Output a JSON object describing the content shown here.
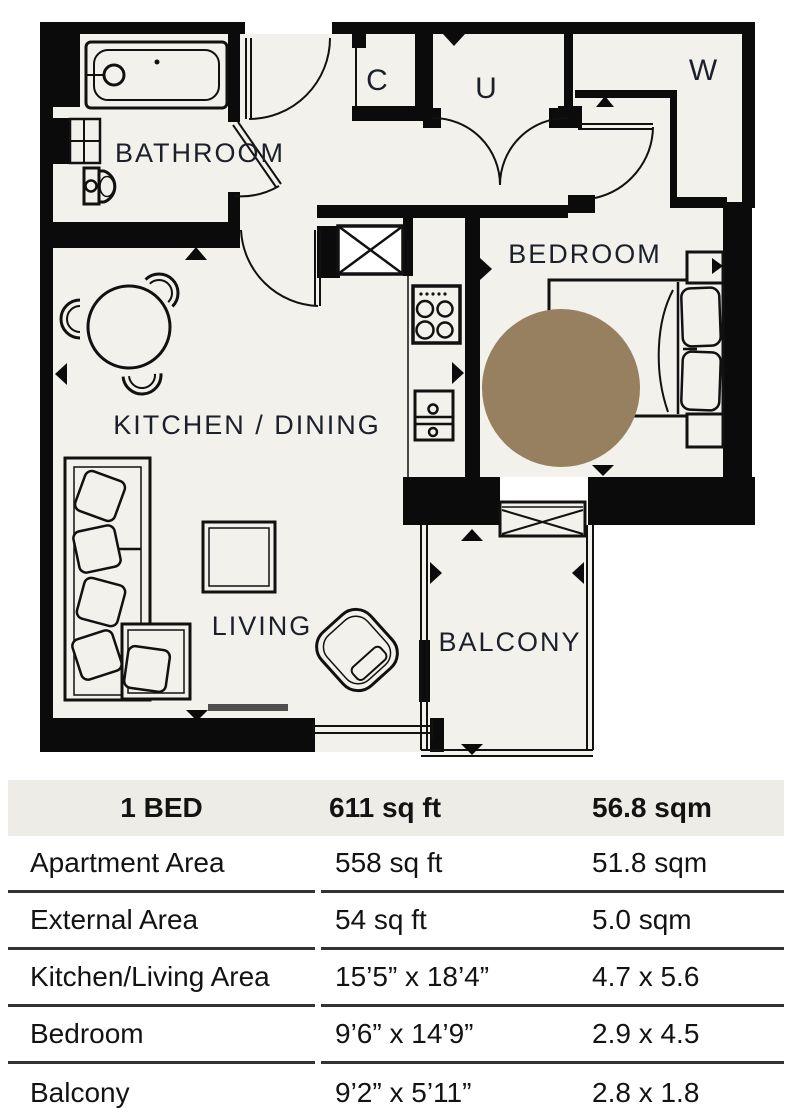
{
  "plan": {
    "labels": {
      "bathroom": "BATHROOM",
      "closet_c": "C",
      "utility_u": "U",
      "wardrobe_w": "W",
      "bedroom": "BEDROOM",
      "kitchen_dining": "KITCHEN / DINING",
      "living": "LIVING",
      "balcony": "BALCONY"
    },
    "marker_color": "#97805f",
    "floor_color": "#f3f1ec",
    "wall_color": "#0b0b0b"
  },
  "table": {
    "header": {
      "col1": "1 BED",
      "col2": "611 sq ft",
      "col3": "56.8 sqm"
    },
    "rows": [
      {
        "label": "Apartment Area",
        "imperial": "558 sq ft",
        "metric": "51.8 sqm"
      },
      {
        "label": "External Area",
        "imperial": "54 sq ft",
        "metric": "5.0 sqm"
      },
      {
        "label": "Kitchen/Living Area",
        "imperial": "15’5” x 18’4”",
        "metric": "4.7 x 5.6"
      },
      {
        "label": "Bedroom",
        "imperial": "9’6” x 14’9”",
        "metric": "2.9 x 4.5"
      },
      {
        "label": "Balcony",
        "imperial": "9’2” x 5’11”",
        "metric": "2.8 x 1.8"
      }
    ]
  }
}
